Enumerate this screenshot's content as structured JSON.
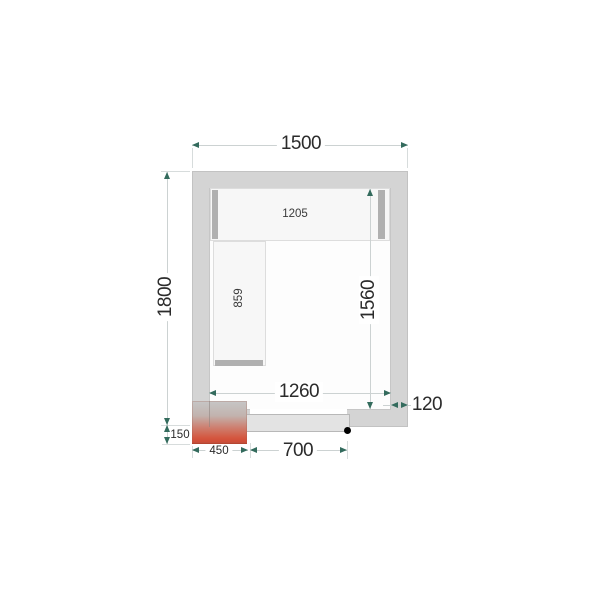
{
  "plan": {
    "dimensions": {
      "outer_width": "1500",
      "outer_depth": "1800",
      "inner_width": "1260",
      "inner_depth": "1560",
      "wall_thickness": "120",
      "door_width": "700",
      "unit_width": "450",
      "unit_depth": "150",
      "top_shelf_length": "1205",
      "left_shelf_length": "859"
    },
    "colors": {
      "wall_fill": "#d4d4d4",
      "interior_fill": "#fdfdfd",
      "shelf_fill": "#f7f7f7",
      "shelf_support": "#b0b0b0",
      "door_fill": "#e3e3e3",
      "unit_gradient_top": "#c6c6c6",
      "unit_gradient_bottom": "#cf4a36",
      "dimension_arrow": "#336b5d",
      "dimension_line": "#ccd2d2",
      "dimension_text": "#2b2b2b",
      "handle_dot": "#000000"
    }
  }
}
